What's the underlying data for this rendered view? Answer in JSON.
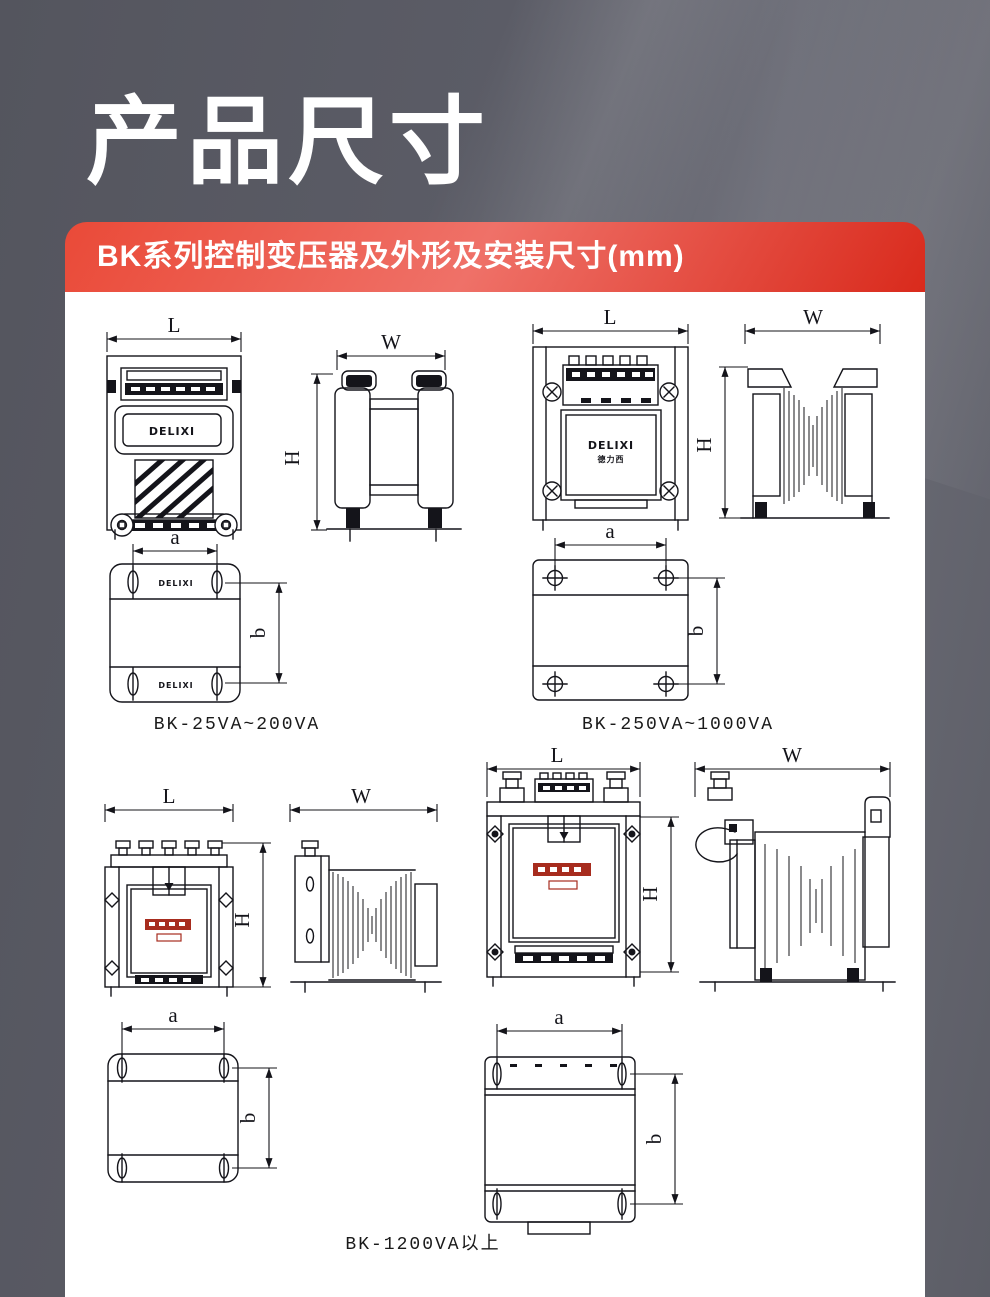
{
  "page_title": "产品尺寸",
  "banner": {
    "title": "BK系列控制变压器及外形及安装尺寸(mm)"
  },
  "dim_labels": {
    "L": "L",
    "W": "W",
    "H": "H",
    "a": "a",
    "b": "b"
  },
  "groups": {
    "small": {
      "caption": "BK-25VA~200VA",
      "brand": "DELIXI"
    },
    "medium": {
      "caption": "BK-250VA~1000VA",
      "brand": "DELIXI",
      "brand_cn": "德力西"
    },
    "large": {
      "caption": "BK-1200VA以上"
    }
  },
  "colors": {
    "background_gray": "#5b5c66",
    "banner_red": "#e8402f",
    "panel_white": "#ffffff",
    "line_black": "#14141a",
    "brand_red": "#a72c1e"
  }
}
